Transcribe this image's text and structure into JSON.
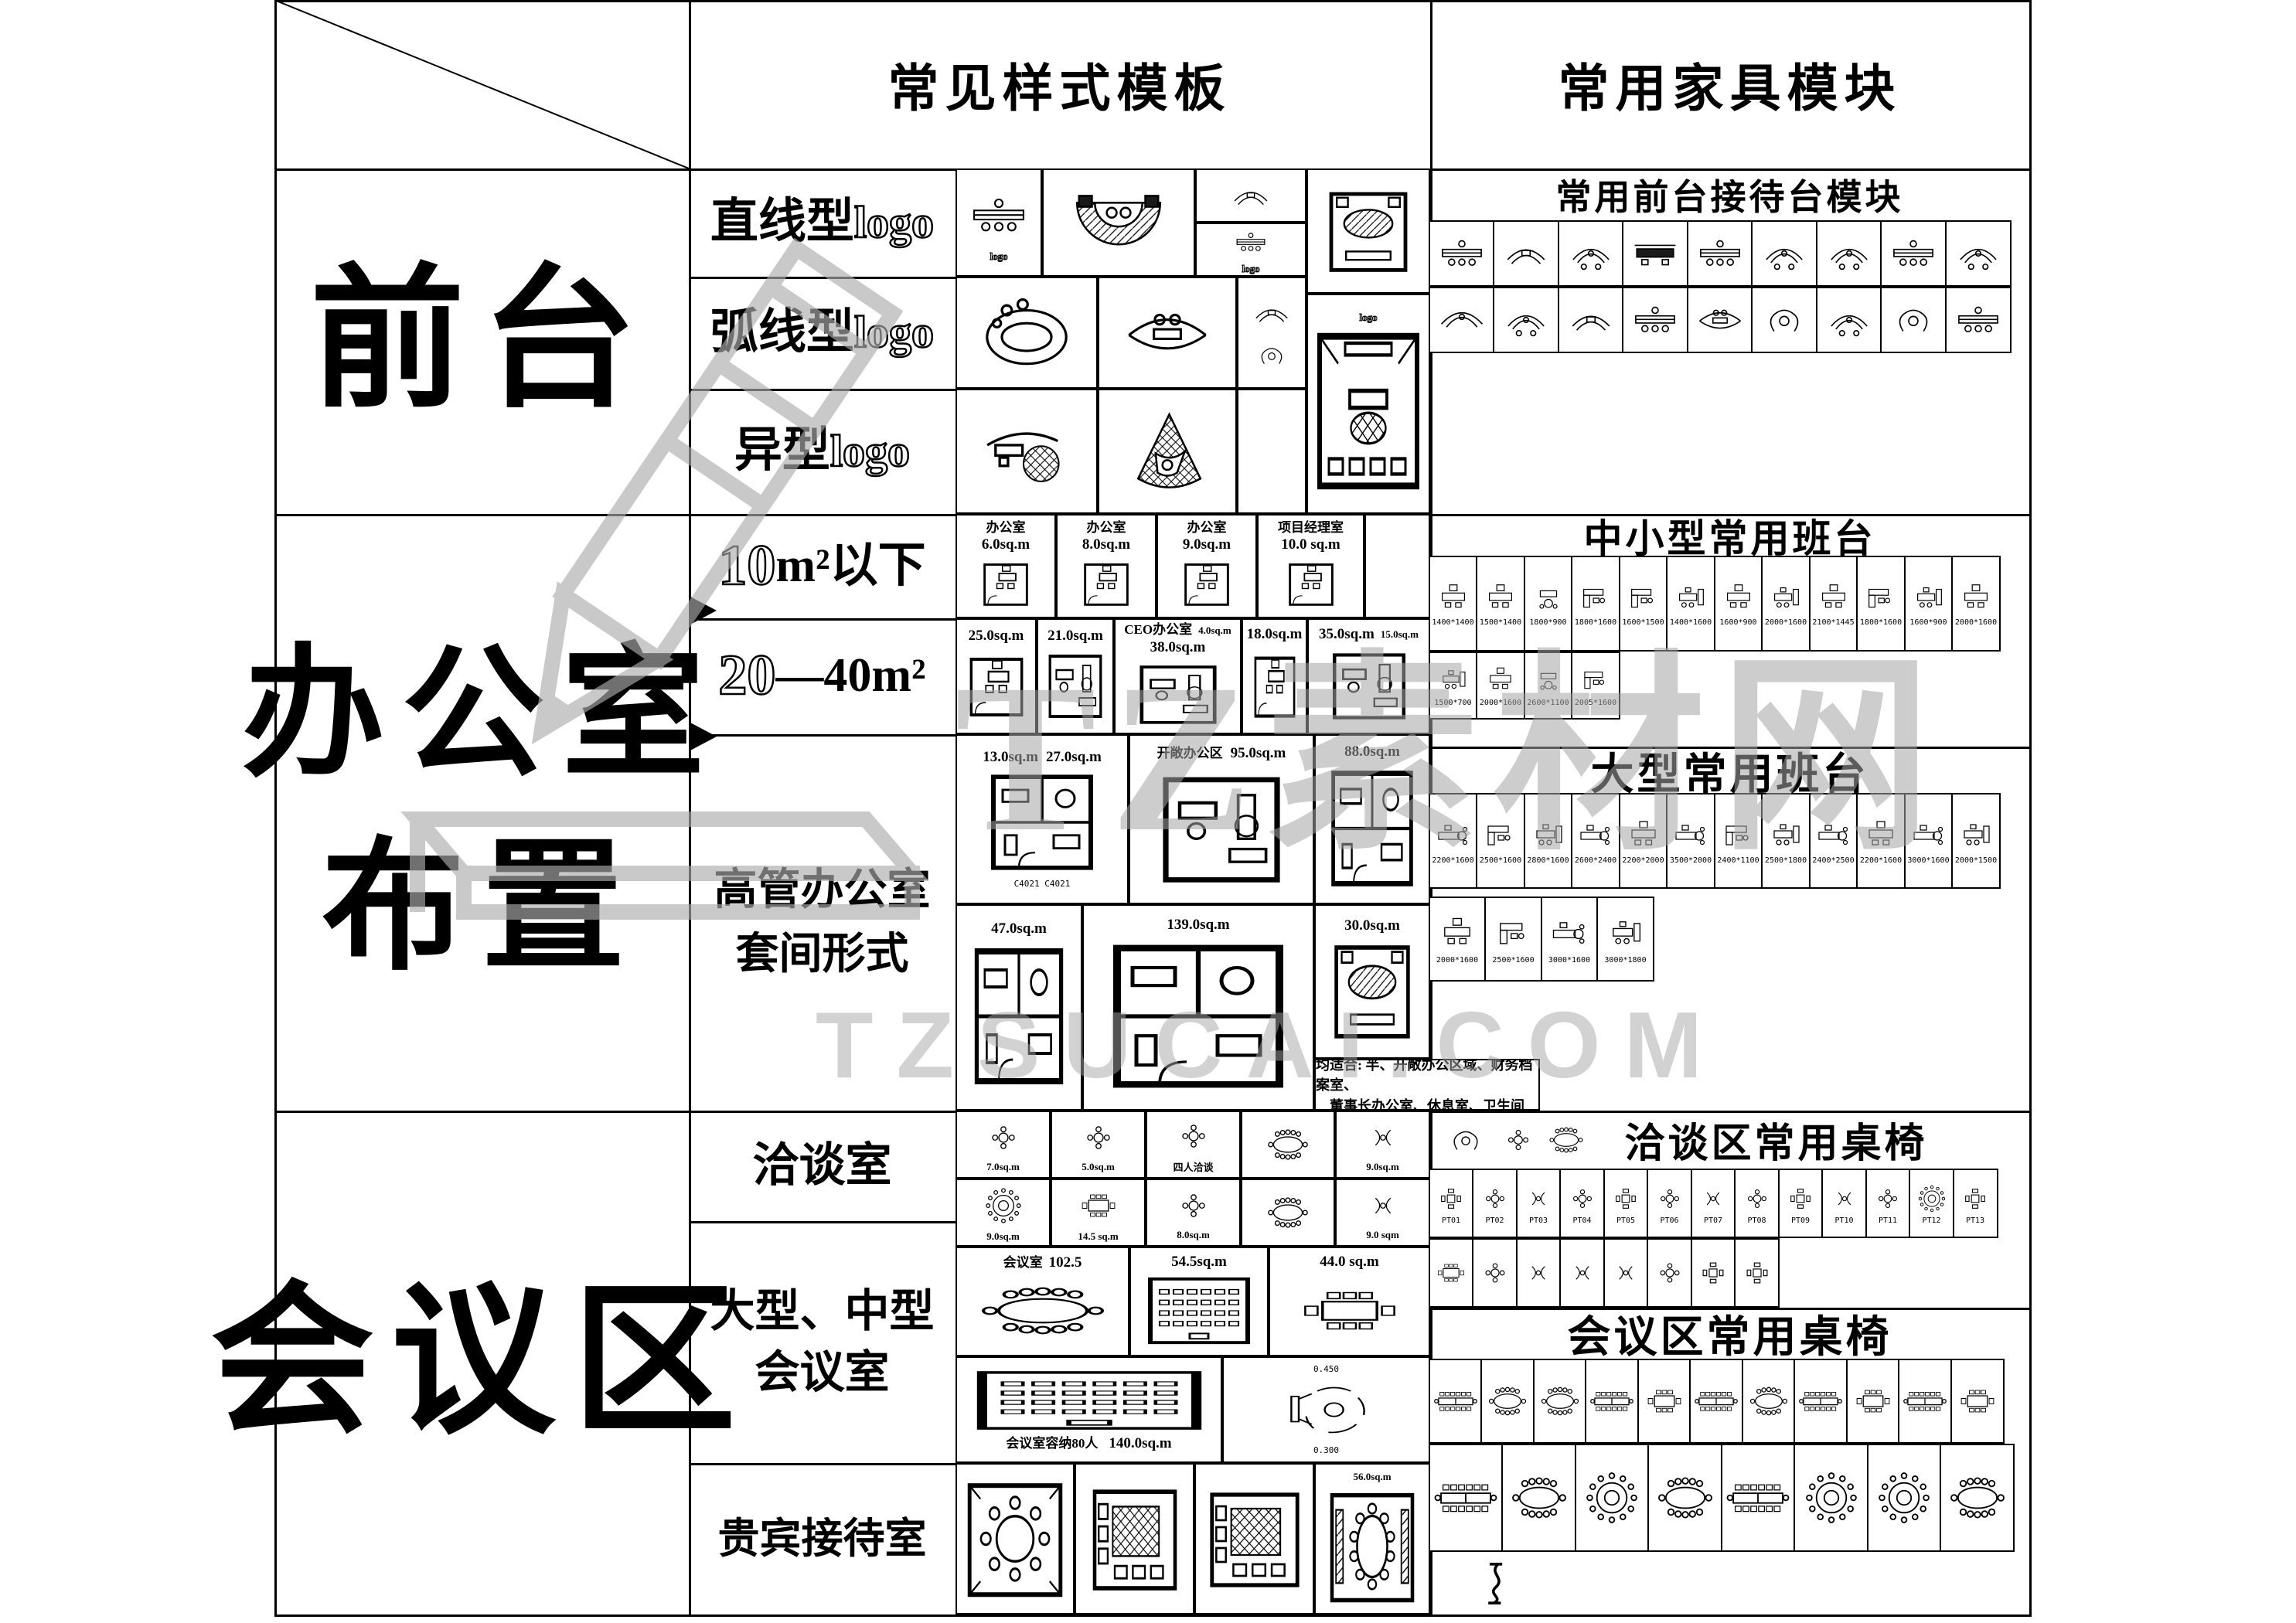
{
  "headers": {
    "style_templates": "常见样式模板",
    "furniture_modules": "常用家具模块"
  },
  "left": {
    "qiantai": "前台",
    "bangong1": "办公室",
    "bangong2": "布置",
    "huiyi": "会议区"
  },
  "rows": {
    "zhixian": "直线型",
    "huxian": "弧线型",
    "yixing": "异型",
    "logo": "logo",
    "n10": "10",
    "s10": "m²以下",
    "n20": "20",
    "s20": "—40m²",
    "gg1": "高管办公室",
    "gg2": "套间形式",
    "qiatan": "洽谈室",
    "dh1": "大型、中型",
    "dh2": "会议室",
    "guibin": "贵宾接待室"
  },
  "furn": {
    "recep_header": "常用前台接待台模块",
    "small_header": "中小型常用班台",
    "large_header": "大型常用班台",
    "qiatan_header": "洽谈区常用桌椅",
    "meeting_header": "会议区常用桌椅",
    "recep_row1": [
      {
        "g": "recep-line"
      },
      {
        "g": "sofa-curve"
      },
      {
        "g": "recep-arc"
      },
      {
        "g": "recep-dark"
      },
      {
        "g": "recep-line"
      },
      {
        "g": "recep-arc"
      },
      {
        "g": "recep-arc"
      },
      {
        "g": "recep-line"
      },
      {
        "g": "recep-arc"
      }
    ],
    "recep_row2": [
      {
        "g": "recep-curve"
      },
      {
        "g": "recep-arc"
      },
      {
        "g": "sofa-curve"
      },
      {
        "g": "recep-line"
      },
      {
        "g": "eye"
      },
      {
        "g": "blob"
      },
      {
        "g": "recep-arc"
      },
      {
        "g": "blob"
      },
      {
        "g": "recep-line"
      }
    ],
    "small_row1": [
      {
        "g": "desk1",
        "label": "1400*1400"
      },
      {
        "g": "desk1",
        "label": "1500*1400"
      },
      {
        "g": "desk-round",
        "label": "1800*900"
      },
      {
        "g": "desk-l",
        "label": "1800*1600"
      },
      {
        "g": "desk-l",
        "label": "1600*1500"
      },
      {
        "g": "desk-side",
        "label": "1400*1600"
      },
      {
        "g": "desk1",
        "label": "1600*900"
      },
      {
        "g": "desk-side",
        "label": "2000*1600"
      },
      {
        "g": "desk1",
        "label": "2100*1445"
      },
      {
        "g": "desk-l",
        "label": "1800*1600"
      },
      {
        "g": "desk-side",
        "label": "1600*900"
      },
      {
        "g": "desk1",
        "label": "2000*1600"
      }
    ],
    "small_row2": [
      {
        "g": "desk-side",
        "label": "1500*700"
      },
      {
        "g": "desk1",
        "label": "2000*1600"
      },
      {
        "g": "desk-round",
        "label": "2600*1100"
      },
      {
        "g": "desk-l",
        "label": "2005*1600"
      }
    ],
    "large_row1": [
      {
        "g": "desk-exec",
        "label": "2200*1600"
      },
      {
        "g": "desk-l",
        "label": "2500*1600"
      },
      {
        "g": "desk-side",
        "label": "2800*1600"
      },
      {
        "g": "desk-exec",
        "label": "2600*2400"
      },
      {
        "g": "desk1",
        "label": "2200*2000"
      },
      {
        "g": "desk-exec",
        "label": "3500*2000"
      },
      {
        "g": "desk-l",
        "label": "2400*1100"
      },
      {
        "g": "desk-side",
        "label": "2500*1800"
      },
      {
        "g": "desk-exec",
        "label": "2400*2500"
      },
      {
        "g": "desk1",
        "label": "2200*1600"
      },
      {
        "g": "desk-exec",
        "label": "3000*1600"
      },
      {
        "g": "desk-side",
        "label": "2000*1500"
      }
    ],
    "large_row2": [
      {
        "g": "desk1",
        "label": "2000*1600"
      },
      {
        "g": "desk-l",
        "label": "2500*1600"
      },
      {
        "g": "desk-exec",
        "label": "3000*1600"
      },
      {
        "g": "desk-side",
        "label": "3000*1800"
      }
    ],
    "qiatan_row1": [
      {
        "g": "table-sq4",
        "label": "PT01"
      },
      {
        "g": "table-round4",
        "label": "PT02"
      },
      {
        "g": "sofa-pair",
        "label": "PT03"
      },
      {
        "g": "table-round4",
        "label": "PT04"
      },
      {
        "g": "table-sq4",
        "label": "PT05"
      },
      {
        "g": "table-round4",
        "label": "PT06"
      },
      {
        "g": "sofa-pair",
        "label": "PT07"
      },
      {
        "g": "table-round4",
        "label": "PT08"
      },
      {
        "g": "table-sq4",
        "label": "PT09"
      },
      {
        "g": "sofa-pair",
        "label": "PT10"
      },
      {
        "g": "table-round4",
        "label": "PT11"
      },
      {
        "g": "conf-roundbig",
        "label": "PT12"
      },
      {
        "g": "table-sq4",
        "label": "PT13"
      }
    ],
    "qiatan_row2": [
      {
        "g": "conf-rect8"
      },
      {
        "g": "table-round4"
      },
      {
        "g": "sofa-pair"
      },
      {
        "g": "sofa-pair"
      },
      {
        "g": "sofa-pair"
      },
      {
        "g": "table-round4"
      },
      {
        "g": "table-sq4"
      },
      {
        "g": "table-sq4"
      }
    ],
    "meeting_row1": [
      {
        "g": "conf-long"
      },
      {
        "g": "conf-oval"
      },
      {
        "g": "conf-oval"
      },
      {
        "g": "conf-long"
      },
      {
        "g": "conf-rect8"
      },
      {
        "g": "conf-long"
      },
      {
        "g": "conf-oval"
      },
      {
        "g": "conf-long"
      },
      {
        "g": "conf-rect8"
      },
      {
        "g": "conf-long"
      },
      {
        "g": "conf-rect8"
      }
    ],
    "meeting_row2": [
      {
        "g": "conf-long"
      },
      {
        "g": "conf-oval"
      },
      {
        "g": "conf-roundbig"
      },
      {
        "g": "conf-oval"
      },
      {
        "g": "conf-long"
      },
      {
        "g": "conf-roundbig"
      },
      {
        "g": "conf-roundbig"
      },
      {
        "g": "conf-oval"
      }
    ]
  },
  "tpl": {
    "logo_mark": "logo",
    "rooms10": [
      {
        "name": "办公室",
        "area": "6.0sq.m"
      },
      {
        "name": "办公室",
        "area": "8.0sq.m"
      },
      {
        "name": "办公室",
        "area": "9.0sq.m"
      },
      {
        "name": "项目经理室",
        "area": "10.0 sq.m"
      }
    ],
    "rooms2040": [
      {
        "area": "25.0sq.m"
      },
      {
        "area": "21.0sq.m"
      },
      {
        "name": "CEO办公室",
        "area": "38.0sq.m",
        "area2": "4.0sq.m"
      },
      {
        "area": "18.0sq.m"
      },
      {
        "area": "35.0sq.m",
        "area2": "15.0sq.m"
      }
    ],
    "suite": {
      "a1_area": "27.0sq.m",
      "a1_area2": "13.0sq.m",
      "codes": "C4021  C4021",
      "a2_name": "开敞办公区",
      "a2_area": "95.0sq.m",
      "a3_area": "88.0sq.m",
      "b1_area": "47.0sq.m",
      "b2_area": "139.0sq.m",
      "b3_area": "30.0sq.m",
      "note1": "均适合: 半、开敞办公区域、财务档案室、",
      "note2": "董事长办公室、休息室、卫生间"
    },
    "qiatan": {
      "c1": "7.0sq.m",
      "c2": "5.0sq.m",
      "c3": "四人洽谈",
      "c5": "9.0sq.m",
      "c6": "9.0sq.m",
      "c7": "14.5 sq.m",
      "c8": "8.0sq.m",
      "c10": "9.0 sqm"
    },
    "meet": {
      "m1_name": "会议室",
      "m1_area": "102.5",
      "m2_area": "54.5sq.m",
      "m3_area": "44.0 sq.m",
      "m4_cap": "会议室容纳80人",
      "m4_area": "140.0sq.m",
      "m5_d1": "0.450",
      "m5_d2": "0.300"
    },
    "vip_area": "56.0sq.m"
  },
  "watermark": {
    "cn": "TZ素材网",
    "en": "TZSUCAI.COM"
  }
}
